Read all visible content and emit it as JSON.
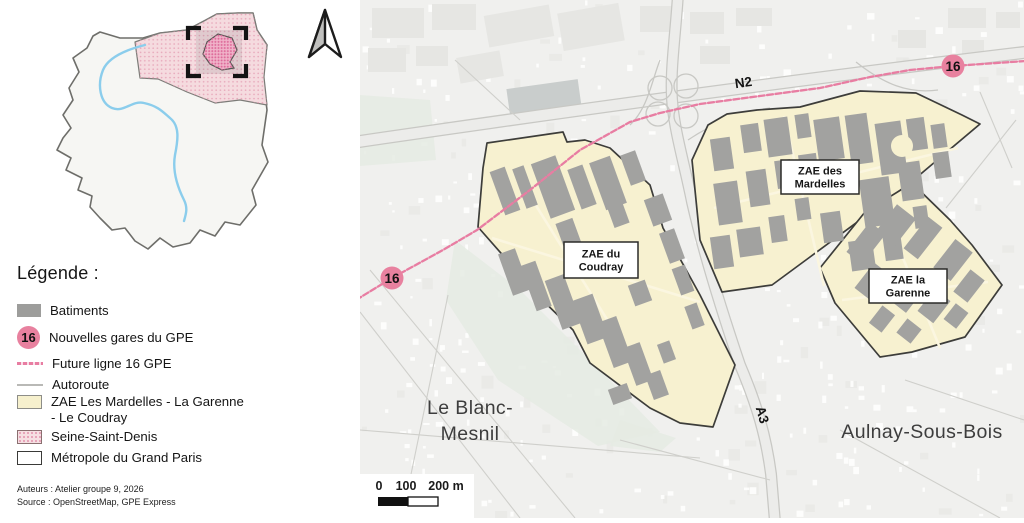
{
  "colors": {
    "rail_pink": "#e87da2",
    "station_pink": "#e8819f",
    "zone_fill": "#f7f1d0",
    "zone_stroke": "#3d3d3a",
    "building_gray": "#a2a2a0",
    "industrial_gray": "#e6e6e3",
    "map_bg": "#f0f0ee",
    "road_casing": "#c8c8c4",
    "road_fill": "#ececea",
    "green_area": "#e5ebe3",
    "ssd_pink": "#f6dfe2"
  },
  "legend": {
    "title": "Légende :",
    "items": [
      {
        "id": "batiments",
        "label": "Batiments"
      },
      {
        "id": "gares-gpe",
        "label": "Nouvelles gares du GPE",
        "badge": "16"
      },
      {
        "id": "ligne-16",
        "label": "Future ligne 16 GPE"
      },
      {
        "id": "autoroute",
        "label": "Autoroute"
      },
      {
        "id": "zae",
        "label": "ZAE Les Mardelles - La Garenne\n- Le Coudray"
      },
      {
        "id": "seine-saint-denis",
        "label": "Seine-Saint-Denis"
      },
      {
        "id": "metropole",
        "label": "Métropole du Grand Paris"
      }
    ],
    "credits": [
      "Auteurs : Atelier groupe 9, 2026",
      "Source : OpenStreetMap, GPE Express"
    ]
  },
  "map": {
    "city_labels": [
      {
        "text": "Le Blanc-",
        "x": 470,
        "y": 414
      },
      {
        "text": "Mesnil",
        "x": 470,
        "y": 440
      },
      {
        "text": "Aulnay-Sous-Bois",
        "x": 922,
        "y": 438
      }
    ],
    "road_labels": [
      {
        "text": "N2",
        "x": 744,
        "y": 87,
        "rot": -8
      },
      {
        "text": "A3",
        "x": 758,
        "y": 416,
        "rot": 74
      }
    ],
    "stations": [
      {
        "label": "16",
        "x": 392,
        "y": 278
      },
      {
        "label": "16",
        "x": 953,
        "y": 66
      }
    ],
    "zone_labels": [
      {
        "lines": [
          "ZAE du",
          "Coudray"
        ],
        "x": 601,
        "y": 260,
        "w": 74,
        "h": 36
      },
      {
        "lines": [
          "ZAE des",
          "Mardelles"
        ],
        "x": 820,
        "y": 177,
        "w": 78,
        "h": 34
      },
      {
        "lines": [
          "ZAE la",
          "Garenne"
        ],
        "x": 908,
        "y": 286,
        "w": 78,
        "h": 34
      }
    ],
    "scalebar": {
      "labels": [
        {
          "text": "0",
          "x": 379
        },
        {
          "text": "100",
          "x": 406
        },
        {
          "text": "200 m",
          "x": 446
        }
      ]
    },
    "zones": [
      {
        "name": "zae-du-coudray",
        "points": "487,143 563,132 567,142 585,140 610,148 650,185 663,228 700,295 735,365 713,427 680,423 650,408 590,363 573,330 523,281 507,260 478,227 483,168"
      },
      {
        "name": "zae-des-mardelles",
        "points": "757,110 800,107 860,91 916,93 962,115 980,124 910,183 810,257 772,285 722,292 700,240 692,160 708,125 727,114"
      },
      {
        "name": "zae-la-garenne",
        "points": "912,183 950,220 972,245 1002,285 965,337 912,352 880,357 835,303 820,268 865,212"
      }
    ],
    "railway_points": "356,300 392,278 443,250 477,230 530,190 580,150 630,122 660,113 700,104 760,96 820,88 870,77 910,70 953,66 1026,61",
    "roads": {
      "n2": "M356,142 C520,118 760,84 1028,52",
      "a3": "M678,-6 C676,30 670,70 672,99 C674,130 684,162 692,202 C702,246 718,300 740,365 C757,405 766,436 771,474 L775,522",
      "ramp_circles": [
        [
          660,
          88,
          12
        ],
        [
          686,
          86,
          12
        ],
        [
          658,
          114,
          12
        ],
        [
          686,
          116,
          12
        ]
      ],
      "ramp_arcs": [
        "M630,125 C648,108 652,80 660,60",
        "M688,140 C710,125 740,112 770,108",
        "M856,62 C884,84 908,94 938,90"
      ],
      "streets": [
        "M370,270 L575,518",
        "M360,312 L520,518",
        "M448,295 L402,518",
        "M360,430 L700,458",
        "M980,92 L1012,168",
        "M1016,120 L946,208",
        "M905,380 L1024,420",
        "M455,60 L520,120",
        "M620,440 L770,480",
        "M840,430 L1000,518"
      ],
      "zone_streets": [
        "M492,238 L700,302",
        "M522,183 L646,382",
        "M714,208 L958,148",
        "M784,116 L824,286",
        "M842,300 L988,282",
        "M884,212 L940,348"
      ]
    },
    "green_areas": [
      "455,240 520,290 600,370 660,432 598,446 498,380 446,300",
      "360,95 430,100 436,160 360,166",
      "620,420 676,438 660,452 610,446"
    ],
    "buildings": {
      "coudray": {
        "rot": -20,
        "rects": [
          [
            497,
            168,
            16,
            46
          ],
          [
            519,
            166,
            12,
            42
          ],
          [
            540,
            158,
            26,
            58
          ],
          [
            574,
            166,
            16,
            42
          ],
          [
            597,
            158,
            22,
            50
          ],
          [
            625,
            152,
            16,
            32
          ],
          [
            505,
            250,
            18,
            44
          ],
          [
            528,
            262,
            16,
            48
          ],
          [
            553,
            276,
            20,
            52
          ],
          [
            579,
            296,
            22,
            46
          ],
          [
            605,
            318,
            20,
            48
          ],
          [
            629,
            344,
            18,
            40
          ],
          [
            649,
            372,
            16,
            26
          ],
          [
            648,
            196,
            20,
            28
          ],
          [
            664,
            230,
            16,
            32
          ],
          [
            676,
            266,
            14,
            28
          ],
          [
            688,
            304,
            13,
            24
          ],
          [
            560,
            220,
            18,
            30
          ],
          [
            610,
            202,
            16,
            24
          ],
          [
            600,
            250,
            22,
            24
          ],
          [
            631,
            282,
            18,
            22
          ],
          [
            610,
            386,
            20,
            16
          ],
          [
            660,
            342,
            13,
            20
          ]
        ]
      },
      "mardelles": {
        "rot": -8,
        "rects": [
          [
            712,
            138,
            20,
            32
          ],
          [
            742,
            124,
            18,
            28
          ],
          [
            766,
            118,
            24,
            38
          ],
          [
            796,
            114,
            14,
            24
          ],
          [
            816,
            118,
            26,
            42
          ],
          [
            848,
            114,
            22,
            50
          ],
          [
            878,
            122,
            26,
            52
          ],
          [
            908,
            118,
            18,
            32
          ],
          [
            932,
            124,
            14,
            24
          ],
          [
            716,
            182,
            24,
            42
          ],
          [
            748,
            170,
            20,
            36
          ],
          [
            776,
            160,
            16,
            28
          ],
          [
            800,
            154,
            18,
            30
          ],
          [
            862,
            178,
            30,
            48
          ],
          [
            900,
            162,
            22,
            38
          ],
          [
            934,
            152,
            16,
            26
          ],
          [
            712,
            236,
            20,
            32
          ],
          [
            738,
            228,
            24,
            28
          ],
          [
            770,
            216,
            16,
            26
          ],
          [
            796,
            198,
            14,
            22
          ],
          [
            822,
            212,
            20,
            30
          ],
          [
            850,
            240,
            24,
            30
          ],
          [
            884,
            234,
            18,
            26
          ],
          [
            914,
            206,
            14,
            22
          ]
        ]
      },
      "garenne": {
        "rot": 38,
        "rects": [
          [
            856,
            224,
            20,
            38
          ],
          [
            884,
            208,
            24,
            34
          ],
          [
            914,
            218,
            18,
            40
          ],
          [
            942,
            242,
            22,
            36
          ],
          [
            960,
            272,
            18,
            28
          ],
          [
            862,
            266,
            22,
            32
          ],
          [
            892,
            278,
            26,
            30
          ],
          [
            924,
            292,
            20,
            28
          ],
          [
            948,
            306,
            16,
            20
          ],
          [
            874,
            308,
            16,
            22
          ],
          [
            900,
            322,
            18,
            18
          ]
        ]
      },
      "industrial": {
        "rot": 0,
        "rects": [
          [
            372,
            8,
            52,
            30,
            0
          ],
          [
            432,
            4,
            44,
            26,
            0
          ],
          [
            486,
            10,
            66,
            32,
            -10
          ],
          [
            560,
            8,
            62,
            38,
            -10
          ],
          [
            640,
            6,
            38,
            26,
            0
          ],
          [
            368,
            48,
            38,
            24,
            0
          ],
          [
            416,
            46,
            32,
            20,
            0
          ],
          [
            458,
            54,
            44,
            26,
            -10
          ],
          [
            690,
            12,
            34,
            22,
            0
          ],
          [
            736,
            8,
            36,
            18,
            0
          ],
          [
            700,
            46,
            30,
            18,
            0
          ],
          [
            948,
            8,
            38,
            20,
            0
          ],
          [
            996,
            12,
            24,
            16,
            0
          ],
          [
            898,
            30,
            28,
            18,
            0
          ],
          [
            962,
            40,
            22,
            14,
            0
          ]
        ]
      },
      "parking": [
        508,
        84,
        72,
        28,
        -8
      ],
      "courtyard": [
        902,
        146,
        11
      ]
    }
  }
}
